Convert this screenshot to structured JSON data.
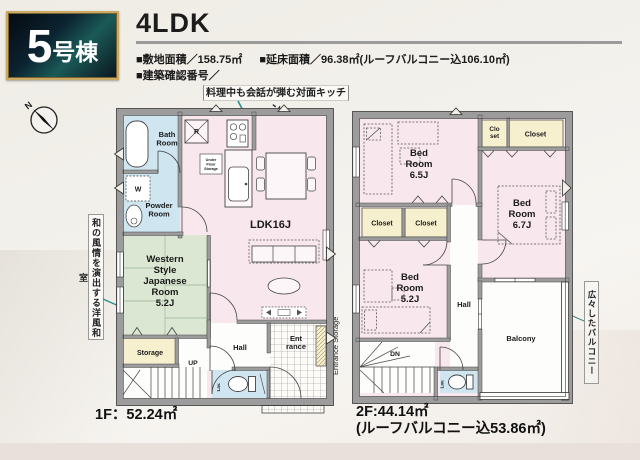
{
  "header": {
    "building_no": "5",
    "building_suffix": "号棟",
    "plan_type": "4LDK",
    "site_area": "■敷地面積／158.75㎡",
    "floor_area": "■延床面積／96.38㎡(ルーフバルコニー込106.10㎡)",
    "confirmation_no": "■建築確認番号／"
  },
  "notes": {
    "kitchen": "料理中も会話が弾む対面キッチン",
    "japanese_room": "和の風情を演出する洋風和室",
    "balcony": "広々したバルコニー",
    "entrance_storage": "Entrance Storage"
  },
  "compass": {
    "north": "N"
  },
  "floor1": {
    "area": "1F：52.24㎡",
    "labels": {
      "bath": [
        "Bath",
        "Room"
      ],
      "powder": [
        "Powder",
        "Room"
      ],
      "washer": "W",
      "japanese": [
        "Western",
        "Style",
        "Japanese",
        "Room",
        "5.2J"
      ],
      "storage": "Storage",
      "up": "UP",
      "hall": "Hall",
      "entrance": [
        "Ent",
        "rance"
      ],
      "lav": "Lav.",
      "ldk": "LDK16J",
      "fridge": "R",
      "underfloor": [
        "Under",
        "Floor",
        "Storage"
      ]
    }
  },
  "floor2": {
    "area": "2F:44.14㎡",
    "area_note": "(ルーフバルコニー込53.86㎡)",
    "labels": {
      "bed65": [
        "Bed",
        "Room",
        "6.5J"
      ],
      "bed67": [
        "Bed",
        "Room",
        "6.7J"
      ],
      "bed52": [
        "Bed",
        "Room",
        "5.2J"
      ],
      "closet_a": [
        "Clo",
        "set"
      ],
      "closet_b": "Closet",
      "closet_c": "Closet",
      "closet_d": "Closet",
      "hall": "Hall",
      "balcony": "Balcony",
      "dn": "DN",
      "lav": "Lav."
    }
  },
  "colors": {
    "wall": "#9c9c9c",
    "room_pink": "#f8e8ee",
    "room_blue": "#cfe6f1",
    "room_green": "#dbe7d2",
    "room_yellow": "#f7f0cf",
    "badge_gold": "#c9a964",
    "callout_teal": "#2e8f8f"
  }
}
